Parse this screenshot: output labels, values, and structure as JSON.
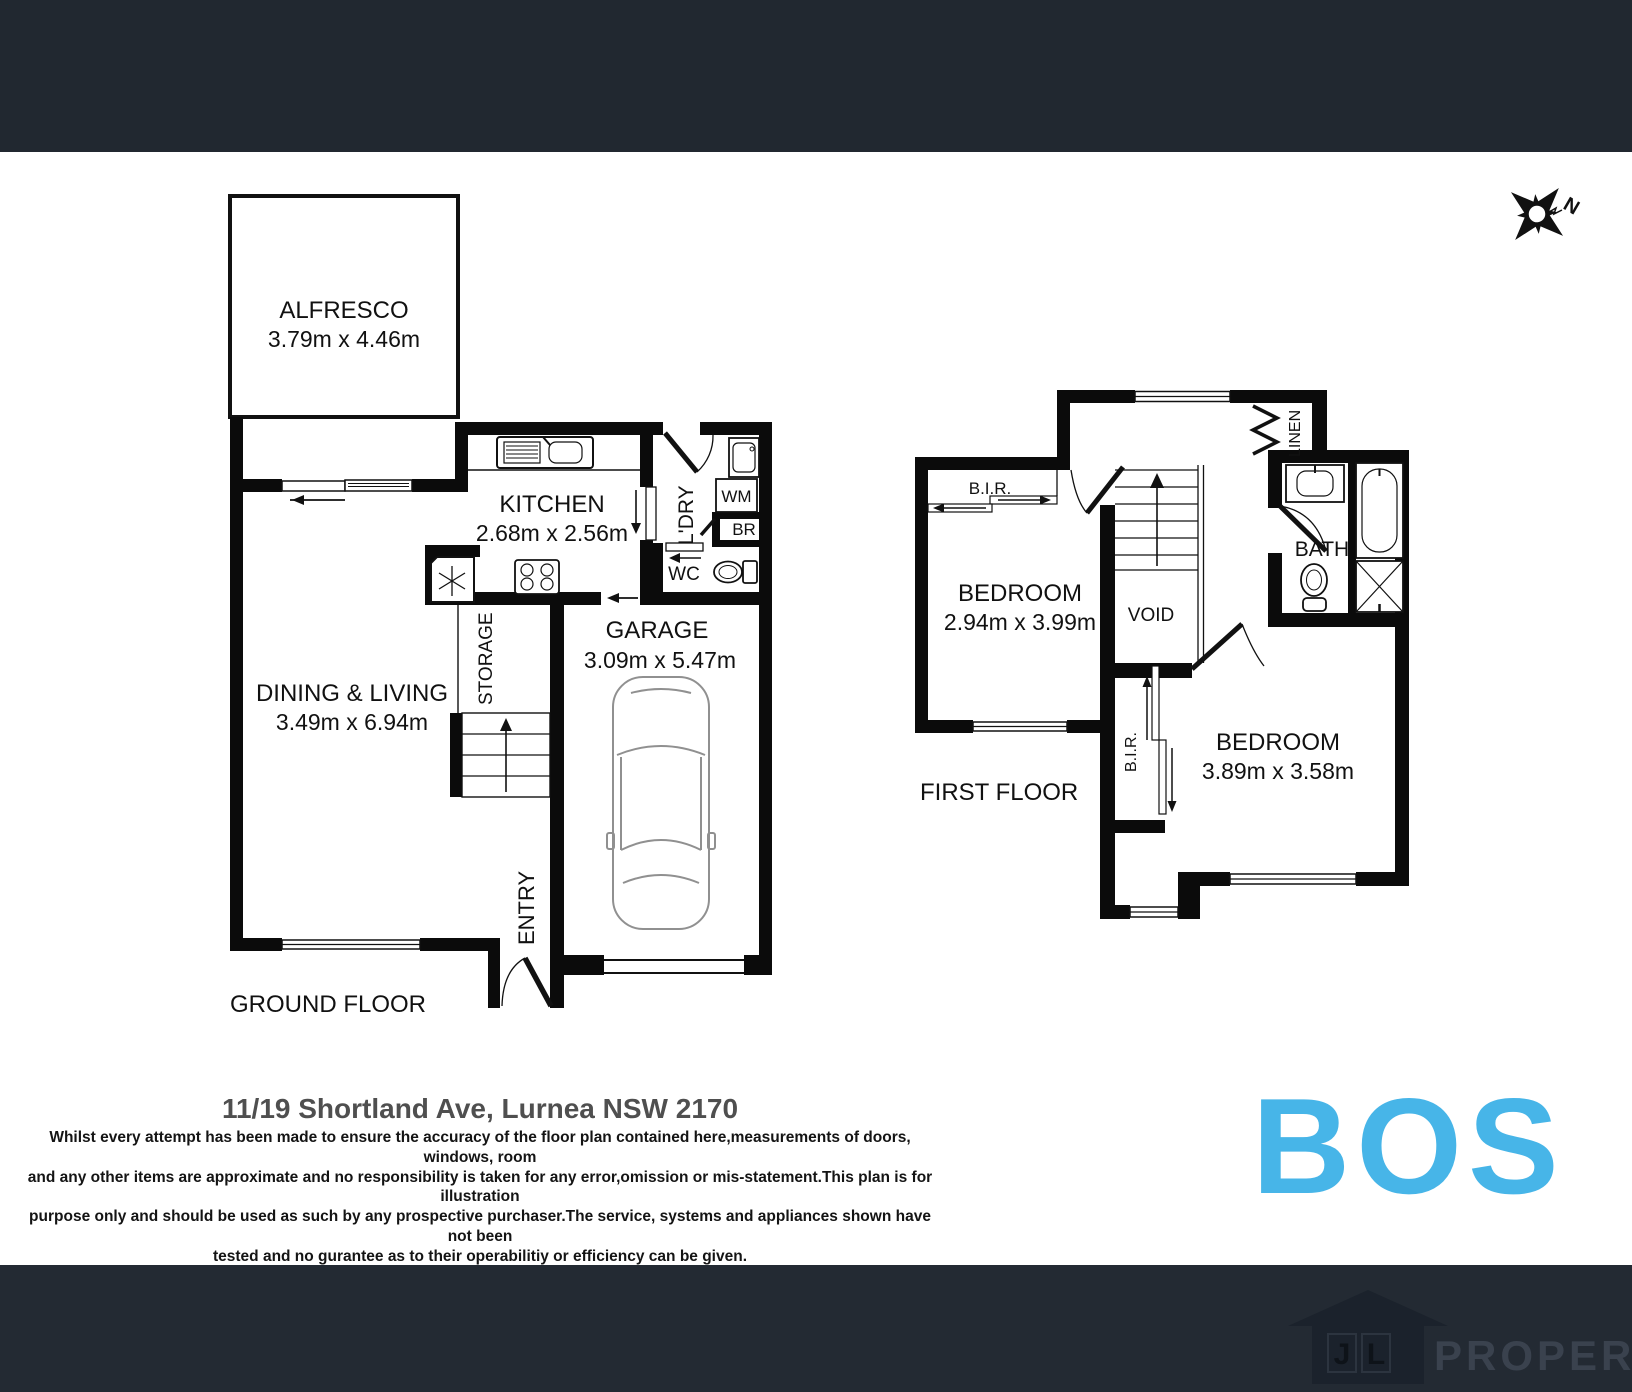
{
  "compass": {
    "north_label": "N"
  },
  "ground_floor": {
    "title": "GROUND FLOOR",
    "alfresco_name": "ALFRESCO",
    "alfresco_dims": "3.79m x 4.46m",
    "kitchen_name": "KITCHEN",
    "kitchen_dims": "2.68m x 2.56m",
    "dining_name": "DINING & LIVING",
    "dining_dims": "3.49m x 6.94m",
    "garage_name": "GARAGE",
    "garage_dims": "3.09m x 5.47m",
    "laundry_label": "L'DRY",
    "wm_label": "WM",
    "br_label": "BR",
    "wc_label": "WC",
    "storage_label": "STORAGE",
    "entry_label": "ENTRY"
  },
  "first_floor": {
    "title": "FIRST FLOOR",
    "bedroom1_name": "BEDROOM",
    "bedroom1_dims": "2.94m x 3.99m",
    "bedroom2_name": "BEDROOM",
    "bedroom2_dims": "3.89m x 3.58m",
    "bath_label": "BATH",
    "void_label": "VOID",
    "linen_label": "LINEN",
    "bir1_label": "B.I.R.",
    "bir2_label": "B.I.R."
  },
  "footer_info": {
    "address": "11/19 Shortland Ave, Lurnea NSW 2170",
    "disclaimer_lines": [
      "Whilst every attempt has been made to ensure the accuracy of the floor plan contained here,measurements of doors, windows, room",
      "and any other items are approximate and no responsibility is taken for any error,omission or mis-statement.This plan is for illustration",
      "purpose only and should be used as such by any prospective purchaser.The service, systems and appliances shown have not been",
      "tested and no gurantee as to their operabilitiy or efficiency can be given."
    ]
  },
  "branding": {
    "bos_wordmark": "BOS",
    "bos_color": "#47b5e8",
    "agency_initials": "JL",
    "agency_name": "PROPERTY",
    "header_color": "#212830",
    "footer_color": "#232a33"
  }
}
